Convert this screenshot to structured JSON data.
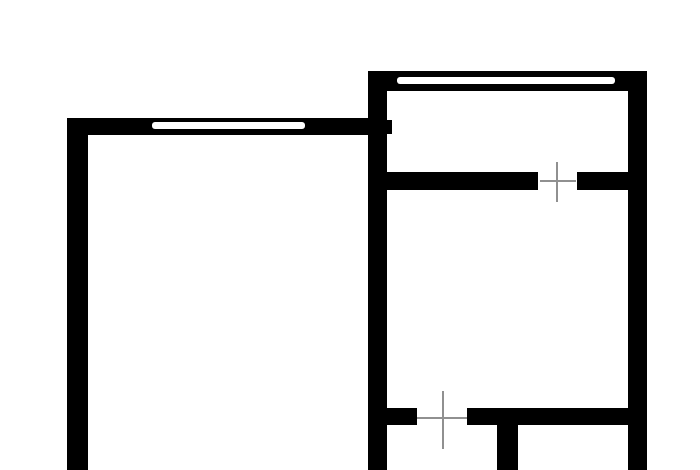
{
  "canvas": {
    "width": 700,
    "height": 470,
    "background_color": "#ffffff"
  },
  "floorplan": {
    "wall_color": "#000000",
    "window_color": "#ffffff",
    "marker_color": "#909090",
    "marker_thickness": 2,
    "walls": [
      {
        "name": "left-room-west-wall",
        "x": 67,
        "y": 118,
        "w": 21,
        "h": 352
      },
      {
        "name": "left-room-north-wall",
        "x": 67,
        "y": 118,
        "w": 301,
        "h": 17
      },
      {
        "name": "center-vertical-wall",
        "x": 368,
        "y": 71,
        "w": 19,
        "h": 399
      },
      {
        "name": "center-wall-stub",
        "x": 387,
        "y": 120,
        "w": 5,
        "h": 14
      },
      {
        "name": "right-unit-north-wall",
        "x": 368,
        "y": 71,
        "w": 279,
        "h": 20
      },
      {
        "name": "right-unit-east-wall",
        "x": 628,
        "y": 71,
        "w": 19,
        "h": 399
      },
      {
        "name": "upper-partition-left-segment",
        "x": 387,
        "y": 172,
        "w": 151,
        "h": 18
      },
      {
        "name": "upper-partition-right-segment",
        "x": 577,
        "y": 172,
        "w": 51,
        "h": 18
      },
      {
        "name": "lower-partition-left-segment",
        "x": 387,
        "y": 408,
        "w": 30,
        "h": 17
      },
      {
        "name": "lower-partition-right-segment",
        "x": 467,
        "y": 408,
        "w": 161,
        "h": 17
      },
      {
        "name": "bottom-stub-wall",
        "x": 497,
        "y": 425,
        "w": 21,
        "h": 45
      }
    ],
    "windows": [
      {
        "name": "left-room-window",
        "x": 152,
        "y": 122,
        "w": 153,
        "h": 7
      },
      {
        "name": "right-unit-window",
        "x": 397,
        "y": 77,
        "w": 218,
        "h": 7
      }
    ],
    "door_markers": [
      {
        "name": "upper-door-marker",
        "cx": 557,
        "cy": 181,
        "v_top": 162,
        "v_bottom": 202,
        "h_left": 540,
        "h_right": 576
      },
      {
        "name": "lower-door-marker",
        "cx": 443,
        "cy": 418,
        "v_top": 391,
        "v_bottom": 449,
        "h_left": 417,
        "h_right": 467
      }
    ]
  }
}
